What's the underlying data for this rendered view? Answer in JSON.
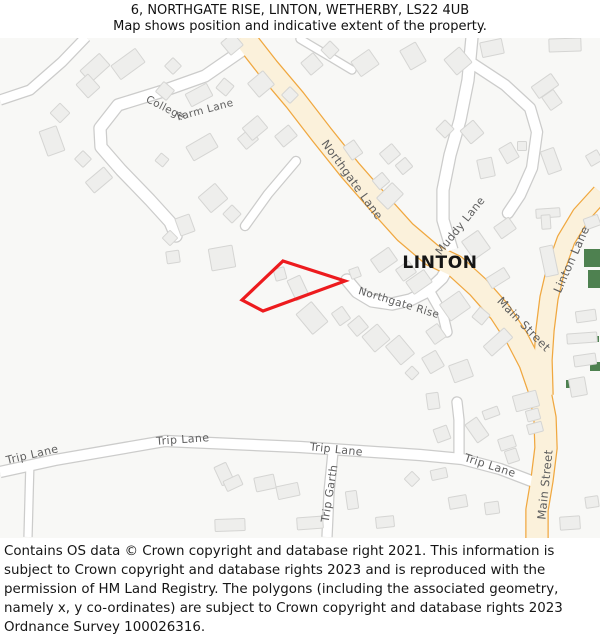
{
  "header": {
    "line1": "6, NORTHGATE RISE, LINTON, WETHERBY, LS22 4UB",
    "line2": "Map shows position and indicative extent of the property."
  },
  "footer": {
    "text": "Contains OS data © Crown copyright and database right 2021. This information is subject to Crown copyright and database rights 2023 and is reproduced with the permission of HM Land Registry. The polygons (including the associated geometry, namely x, y co-ordinates) are subject to Crown copyright and database rights 2023 Ordnance Survey 100026316."
  },
  "map": {
    "colors": {
      "bg": "#f8f8f6",
      "road_major_fill": "#fbf1db",
      "road_major_casing": "#f0a840",
      "road_minor_fill": "#ffffff",
      "road_minor_casing": "#cccccb",
      "building_fill": "#eeeeec",
      "building_stroke": "#d5d5d3",
      "green": "#4e8150",
      "road_label": "#5f5f5f",
      "place_label": "#151515",
      "property_outline": "#ed1b1e"
    },
    "roads": [
      {
        "name": "trip-stub-left-road",
        "type": "minor",
        "width": 7,
        "cap": "butt",
        "path": "M 30,461 L 28,537"
      },
      {
        "name": "trip-garth-road",
        "type": "minor",
        "width": 9,
        "cap": "butt",
        "path": "M 333,452 L 329,492 L 327,537"
      },
      {
        "name": "trip-stub-up-road",
        "type": "minor",
        "width": 9,
        "cap": "round",
        "path": "M 459,457 L 459,420 L 457,402"
      },
      {
        "name": "trip-lane-road",
        "type": "minor",
        "width": 10,
        "cap": "butt",
        "path": "M 0,472 L 55,460 L 165,441 L 300,447 L 420,455 L 462,459 L 500,469 L 534,482"
      },
      {
        "name": "topleft-lane-road",
        "type": "minor",
        "width": 9,
        "cap": "butt",
        "path": "M 86,37 L 62,62 L 30,90 L 0,100"
      },
      {
        "name": "ne-stub-road",
        "type": "minor",
        "width": 7,
        "cap": "round",
        "path": "M 300,39 L 332,58 L 352,70"
      },
      {
        "name": "college-farm-driveway",
        "type": "minor",
        "width": 8,
        "cap": "round",
        "path": "M 296,161 L 268,194 L 245,226"
      },
      {
        "name": "college-farm-lane-road",
        "type": "minor",
        "width": 11,
        "cap": "round",
        "path": "M 247,47 L 205,76 L 160,92 L 118,105 L 100,128 L 101,147 L 121,170 L 150,200 L 170,222 L 176,236"
      },
      {
        "name": "muddy-loop-road",
        "type": "minor",
        "width": 10,
        "cap": "round",
        "path": "M 470,62 L 505,85 L 530,108 L 537,132 L 532,168 L 520,195 L 508,213"
      },
      {
        "name": "muddy-lane-road",
        "type": "minor",
        "width": 11,
        "cap": "butt",
        "path": "M 472,37 L 468,80 L 460,120 L 450,155 L 443,190 L 443,220 L 452,250"
      },
      {
        "name": "northgate-rise-stub-road",
        "type": "minor",
        "width": 9,
        "cap": "round",
        "path": "M 430,292 L 443,315 L 447,332"
      },
      {
        "name": "northgate-rise-road",
        "type": "minor",
        "width": 11,
        "cap": "round",
        "path": "M 452,260 L 442,278 L 428,291 L 410,300 L 392,304 L 372,301 L 357,292 L 347,280"
      },
      {
        "name": "linton-lane-road",
        "type": "major",
        "width": 17,
        "cap": "butt",
        "path": "M 601,193 L 581,215 L 566,240 L 556,268 L 549,298 L 545,330 L 543,360 L 544,395"
      },
      {
        "name": "northgate-lane-main-street-road",
        "type": "major",
        "width": 21,
        "cap": "butt",
        "path": "M 243,36 L 268,68 L 295,100 L 322,135 L 350,170 L 378,202 L 405,232 L 432,255 L 455,266 L 478,287 L 500,312 L 517,338 L 530,363 L 540,392 L 545,418 L 546,448 L 542,480 L 537,510 L 537,538"
      }
    ],
    "green_areas": [
      [
        584,
        249,
        16,
        18
      ],
      [
        588,
        270,
        12,
        18
      ],
      [
        593,
        336,
        6,
        6
      ],
      [
        590,
        362,
        10,
        9
      ],
      [
        566,
        380,
        12,
        8
      ]
    ],
    "buildings": [
      [
        95,
        68,
        26,
        16,
        -42
      ],
      [
        88,
        86,
        16,
        18,
        -42
      ],
      [
        128,
        64,
        30,
        17,
        -36
      ],
      [
        173,
        66,
        12,
        12,
        45
      ],
      [
        165,
        91,
        14,
        13,
        40
      ],
      [
        199,
        95,
        24,
        14,
        -28
      ],
      [
        225,
        87,
        13,
        13,
        40
      ],
      [
        60,
        113,
        14,
        14,
        45
      ],
      [
        52,
        141,
        18,
        26,
        -20
      ],
      [
        83,
        159,
        12,
        12,
        45
      ],
      [
        99,
        180,
        24,
        14,
        -40
      ],
      [
        162,
        160,
        10,
        10,
        40
      ],
      [
        202,
        147,
        28,
        16,
        -30
      ],
      [
        213,
        198,
        22,
        20,
        -40
      ],
      [
        232,
        214,
        13,
        13,
        45
      ],
      [
        185,
        225,
        15,
        18,
        -20
      ],
      [
        222,
        258,
        24,
        22,
        -10
      ],
      [
        173,
        257,
        13,
        12,
        -8
      ],
      [
        170,
        238,
        11,
        11,
        45
      ],
      [
        248,
        139,
        16,
        14,
        -40
      ],
      [
        261,
        84,
        20,
        18,
        -40
      ],
      [
        232,
        44,
        16,
        16,
        -40
      ],
      [
        255,
        128,
        20,
        16,
        -40
      ],
      [
        286,
        136,
        18,
        14,
        -40
      ],
      [
        290,
        95,
        12,
        12,
        45
      ],
      [
        312,
        64,
        16,
        16,
        -40
      ],
      [
        330,
        50,
        13,
        13,
        45
      ],
      [
        365,
        63,
        22,
        18,
        -35
      ],
      [
        413,
        56,
        18,
        22,
        -30
      ],
      [
        458,
        61,
        20,
        20,
        -40
      ],
      [
        492,
        48,
        22,
        15,
        -12
      ],
      [
        565,
        45,
        32,
        13,
        -2
      ],
      [
        545,
        86,
        24,
        14,
        -35
      ],
      [
        552,
        100,
        14,
        16,
        -35
      ],
      [
        353,
        150,
        13,
        16,
        -35
      ],
      [
        390,
        154,
        16,
        14,
        -40
      ],
      [
        381,
        181,
        13,
        12,
        -40
      ],
      [
        390,
        196,
        22,
        16,
        -45
      ],
      [
        404,
        166,
        13,
        12,
        -40
      ],
      [
        445,
        129,
        13,
        13,
        45
      ],
      [
        472,
        132,
        17,
        17,
        -40
      ],
      [
        486,
        168,
        15,
        19,
        -12
      ],
      [
        509,
        153,
        14,
        17,
        -30
      ],
      [
        522,
        146,
        9,
        9,
        0
      ],
      [
        551,
        161,
        14,
        24,
        -20
      ],
      [
        594,
        158,
        13,
        12,
        -30
      ],
      [
        548,
        213,
        24,
        9,
        -4
      ],
      [
        546,
        222,
        9,
        14,
        -4
      ],
      [
        592,
        222,
        15,
        11,
        -20
      ],
      [
        549,
        261,
        13,
        30,
        -12
      ],
      [
        476,
        245,
        20,
        22,
        -35
      ],
      [
        505,
        228,
        18,
        14,
        -35
      ],
      [
        498,
        278,
        21,
        12,
        -32
      ],
      [
        419,
        282,
        22,
        15,
        -35
      ],
      [
        384,
        260,
        22,
        16,
        -35
      ],
      [
        406,
        271,
        16,
        14,
        -35
      ],
      [
        280,
        274,
        11,
        12,
        -15
      ],
      [
        298,
        288,
        14,
        22,
        -25
      ],
      [
        312,
        318,
        20,
        26,
        -40
      ],
      [
        341,
        316,
        13,
        15,
        -35
      ],
      [
        358,
        326,
        15,
        15,
        -40
      ],
      [
        376,
        338,
        20,
        20,
        -40
      ],
      [
        400,
        350,
        18,
        24,
        -40
      ],
      [
        412,
        373,
        10,
        10,
        45
      ],
      [
        433,
        362,
        16,
        18,
        -30
      ],
      [
        436,
        334,
        14,
        16,
        -35
      ],
      [
        455,
        306,
        24,
        20,
        -35
      ],
      [
        481,
        316,
        13,
        13,
        40
      ],
      [
        461,
        371,
        20,
        18,
        -20
      ],
      [
        498,
        342,
        28,
        13,
        -42
      ],
      [
        355,
        273,
        10,
        10,
        -20
      ],
      [
        433,
        401,
        12,
        16,
        -8
      ],
      [
        442,
        434,
        14,
        14,
        -20
      ],
      [
        477,
        430,
        14,
        22,
        -35
      ],
      [
        491,
        413,
        16,
        9,
        -20
      ],
      [
        526,
        401,
        24,
        16,
        -15
      ],
      [
        533,
        415,
        13,
        11,
        -15
      ],
      [
        535,
        428,
        15,
        10,
        -15
      ],
      [
        507,
        443,
        16,
        12,
        -18
      ],
      [
        512,
        456,
        12,
        13,
        -18
      ],
      [
        439,
        474,
        16,
        10,
        -12
      ],
      [
        412,
        479,
        11,
        11,
        45
      ],
      [
        458,
        502,
        18,
        12,
        -10
      ],
      [
        492,
        508,
        14,
        12,
        -8
      ],
      [
        570,
        523,
        20,
        13,
        -4
      ],
      [
        592,
        502,
        13,
        11,
        -8
      ],
      [
        586,
        316,
        20,
        11,
        -8
      ],
      [
        582,
        338,
        30,
        10,
        -4
      ],
      [
        585,
        360,
        22,
        11,
        -8
      ],
      [
        578,
        387,
        16,
        18,
        -10
      ],
      [
        224,
        474,
        13,
        20,
        -25
      ],
      [
        233,
        483,
        17,
        11,
        -25
      ],
      [
        265,
        483,
        20,
        14,
        -12
      ],
      [
        288,
        491,
        22,
        13,
        -12
      ],
      [
        230,
        525,
        30,
        12,
        -2
      ],
      [
        310,
        523,
        26,
        12,
        -4
      ],
      [
        352,
        500,
        11,
        18,
        -8
      ],
      [
        385,
        522,
        18,
        11,
        -6
      ]
    ],
    "property_polygon": {
      "points": "283,261 345,281 263,311 242,300",
      "stroke_width": 3.2
    },
    "labels": [
      {
        "text": "College",
        "x": 164,
        "y": 111,
        "rotate": 27,
        "size": 10.5,
        "type": "road"
      },
      {
        "text": "Farm Lane",
        "x": 206,
        "y": 113,
        "rotate": -15,
        "size": 10.5,
        "type": "road"
      },
      {
        "text": "Northgate Lane",
        "x": 349,
        "y": 182,
        "rotate": 54,
        "size": 11.5,
        "type": "road"
      },
      {
        "text": "Muddy Lane",
        "x": 463,
        "y": 228,
        "rotate": -51,
        "size": 11,
        "type": "road"
      },
      {
        "text": "Northgate Rise",
        "x": 398,
        "y": 306,
        "rotate": 17,
        "size": 10.5,
        "type": "road"
      },
      {
        "text": "Linton Lane",
        "x": 575,
        "y": 261,
        "rotate": -66,
        "size": 11.5,
        "type": "road"
      },
      {
        "text": "Main Street",
        "x": 521,
        "y": 327,
        "rotate": 46,
        "size": 11.5,
        "type": "road"
      },
      {
        "text": "Main Street",
        "x": 549,
        "y": 485,
        "rotate": -84,
        "size": 11.5,
        "type": "road"
      },
      {
        "text": "Trip Lane",
        "x": 33,
        "y": 458,
        "rotate": -13,
        "size": 11,
        "type": "road"
      },
      {
        "text": "Trip Lane",
        "x": 183,
        "y": 443,
        "rotate": -4,
        "size": 11,
        "type": "road"
      },
      {
        "text": "Trip Lane",
        "x": 336,
        "y": 453,
        "rotate": 6,
        "size": 11,
        "type": "road"
      },
      {
        "text": "Trip Lane",
        "x": 489,
        "y": 469,
        "rotate": 18,
        "size": 11,
        "type": "road"
      },
      {
        "text": "Trip Garth",
        "x": 333,
        "y": 494,
        "rotate": -81,
        "size": 11,
        "type": "road"
      },
      {
        "text": "LINTON",
        "x": 440,
        "y": 268,
        "rotate": 0,
        "size": 17,
        "type": "place"
      }
    ]
  }
}
